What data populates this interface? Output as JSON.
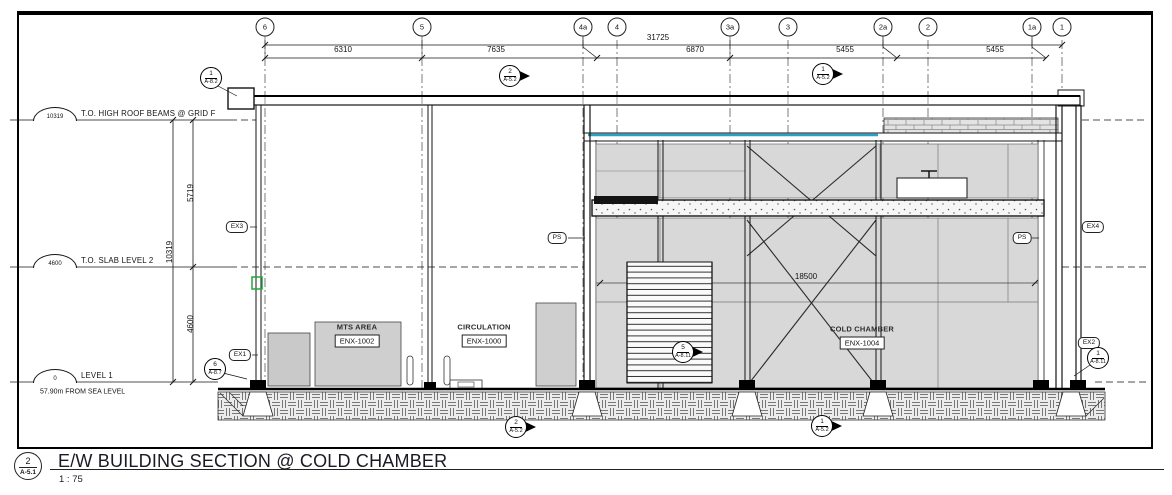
{
  "page": {
    "background": "#ffffff",
    "line_color": "#141414",
    "panel_gray": "#d8d8d8",
    "accent_teal": "#2b9fc6",
    "accent_green": "#1fa83d"
  },
  "title_block": {
    "detail_number": "2",
    "sheet_ref": "A-5.1",
    "title": "E/W BUILDING SECTION @ COLD CHAMBER",
    "scale": "1 : 75"
  },
  "grid_bubbles": [
    {
      "label": "6",
      "x": 265
    },
    {
      "label": "5",
      "x": 422
    },
    {
      "label": "4a",
      "x": 583
    },
    {
      "label": "4",
      "x": 617
    },
    {
      "label": "3a",
      "x": 730
    },
    {
      "label": "3",
      "x": 788
    },
    {
      "label": "2a",
      "x": 883
    },
    {
      "label": "2",
      "x": 928
    },
    {
      "label": "1a",
      "x": 1032
    },
    {
      "label": "1",
      "x": 1062
    }
  ],
  "dimensions": {
    "overall_width": {
      "value": "31725",
      "x": 658,
      "y": 38
    },
    "segments": [
      {
        "value": "6310",
        "x": 343,
        "y": 50
      },
      {
        "value": "7635",
        "x": 496,
        "y": 50
      },
      {
        "value": "6870",
        "x": 695,
        "y": 50
      },
      {
        "value": "5455",
        "x": 845,
        "y": 50
      },
      {
        "value": "5455",
        "x": 995,
        "y": 50
      }
    ],
    "vertical": [
      {
        "value": "5719",
        "x": 191,
        "y": 193
      },
      {
        "value": "10319",
        "x": 170,
        "y": 252
      },
      {
        "value": "4600",
        "x": 191,
        "y": 324
      }
    ],
    "interior_width": {
      "value": "18500",
      "x": 806,
      "y": 277
    }
  },
  "levels": [
    {
      "elevation": "10319",
      "label": "T.O. HIGH ROOF BEAMS @ GRID F",
      "y": 120
    },
    {
      "elevation": "4600",
      "label": "T.O. SLAB LEVEL 2",
      "y": 267
    },
    {
      "elevation": "0",
      "label": "LEVEL 1",
      "sublabel": "57.90m  FROM SEA LEVEL",
      "y": 382
    }
  ],
  "rooms": [
    {
      "name": "MTS AREA",
      "tag": "ENX-1002",
      "x": 357,
      "y": 327
    },
    {
      "name": "CIRCULATION",
      "tag": "ENX-1000",
      "x": 484,
      "y": 327
    },
    {
      "name": "COLD CHAMBER",
      "tag": "ENX-1004",
      "x": 862,
      "y": 329
    }
  ],
  "reference_tags": [
    {
      "label": "EX3",
      "x": 237,
      "y": 227
    },
    {
      "label": "EX1",
      "x": 240,
      "y": 355
    },
    {
      "label": "PS",
      "x": 557,
      "y": 238
    },
    {
      "label": "PS",
      "x": 1022,
      "y": 238
    },
    {
      "label": "EX4",
      "x": 1093,
      "y": 227
    },
    {
      "label": "EX2",
      "x": 1089,
      "y": 343
    }
  ],
  "section_markers": [
    {
      "num": "1",
      "sheet": "A-8.2",
      "x": 211,
      "y": 78,
      "arrow": false
    },
    {
      "num": "2",
      "sheet": "A-5.2",
      "x": 510,
      "y": 76,
      "arrow": true
    },
    {
      "num": "1",
      "sheet": "A-5.2",
      "x": 823,
      "y": 74,
      "arrow": true
    },
    {
      "num": "6",
      "sheet": "A-8.7",
      "x": 215,
      "y": 369,
      "arrow": false
    },
    {
      "num": "5",
      "sheet": "A-8.11",
      "x": 683,
      "y": 352,
      "arrow": true
    },
    {
      "num": "1",
      "sheet": "A-8.11",
      "x": 1098,
      "y": 358,
      "arrow": false
    },
    {
      "num": "2",
      "sheet": "A-5.2",
      "x": 516,
      "y": 427,
      "arrow": true
    },
    {
      "num": "1",
      "sheet": "A-5.2",
      "x": 822,
      "y": 426,
      "arrow": true
    }
  ]
}
